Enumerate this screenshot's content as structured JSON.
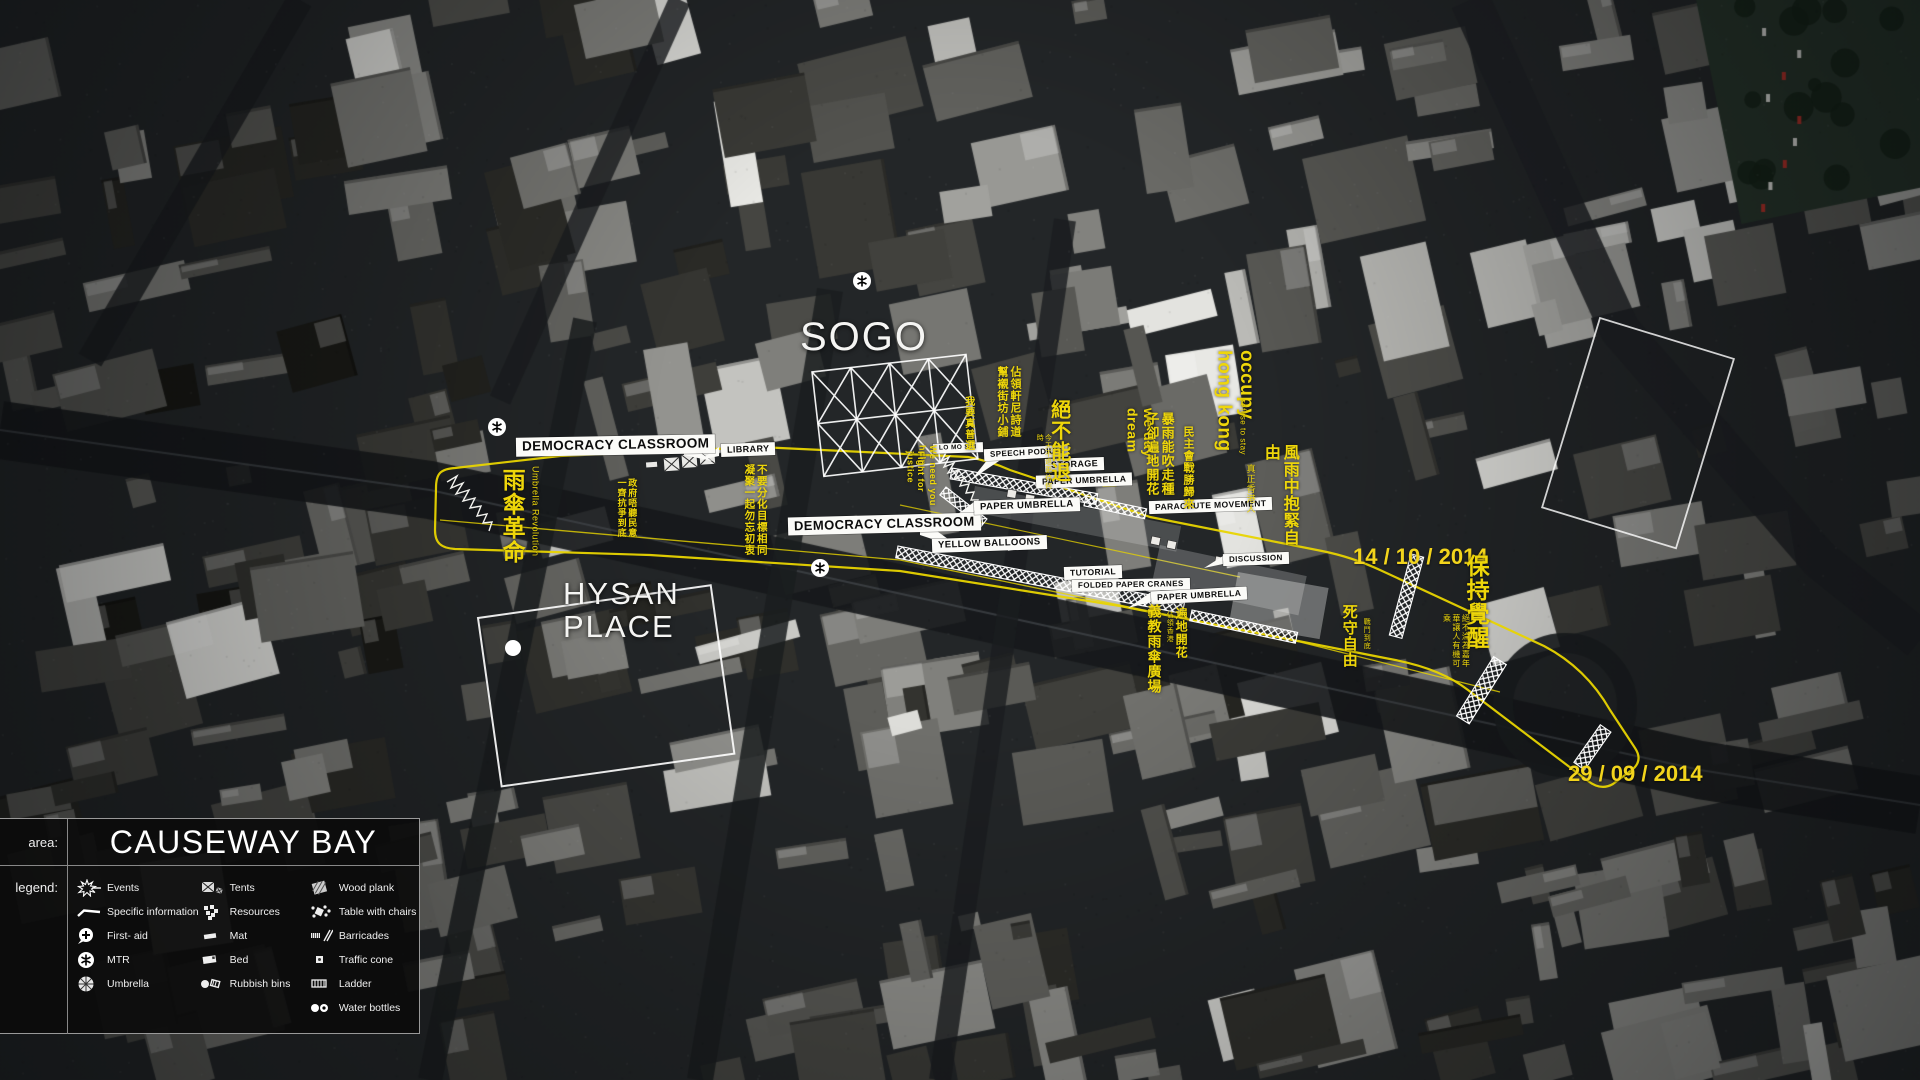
{
  "colors": {
    "annotation_yellow": "#eed60a",
    "date_yellow": "#f2d41c",
    "callout_bg": "#ffffff",
    "callout_text": "#0c0c0c",
    "panel_bg": "#0c0c0c"
  },
  "panel": {
    "area_label": "area:",
    "area_value": "CAUSEWAY BAY",
    "legend_label": "legend:",
    "columns": [
      {
        "items": [
          {
            "icon": "events-icon",
            "label": "Events"
          },
          {
            "icon": "specific-information-icon",
            "label": "Specific information"
          },
          {
            "icon": "first-aid-icon",
            "label": "First- aid"
          },
          {
            "icon": "mtr-icon",
            "label": "MTR"
          },
          {
            "icon": "umbrella-icon",
            "label": "Umbrella"
          }
        ]
      },
      {
        "items": [
          {
            "icon": "tents-icon",
            "label": "Tents"
          },
          {
            "icon": "resources-icon",
            "label": "Resources"
          },
          {
            "icon": "mat-icon",
            "label": "Mat"
          },
          {
            "icon": "bed-icon",
            "label": "Bed"
          },
          {
            "icon": "rubbish-bins-icon",
            "label": "Rubbish bins"
          }
        ]
      },
      {
        "items": [
          {
            "icon": "wood-plank-icon",
            "label": "Wood plank"
          },
          {
            "icon": "table-with-chairs-icon",
            "label": "Table with chairs"
          },
          {
            "icon": "barricades-icon",
            "label": "Barricades"
          },
          {
            "icon": "traffic-cone-icon",
            "label": "Traffic cone"
          },
          {
            "icon": "ladder-icon",
            "label": "Ladder"
          },
          {
            "icon": "water-bottles-icon",
            "label": "Water bottles"
          }
        ]
      }
    ]
  },
  "map": {
    "places": {
      "sogo": "SOGO",
      "hysan_line1": "HYSAN",
      "hysan_line2": "PLACE"
    },
    "dates": [
      {
        "text": "14 / 10 / 2014"
      },
      {
        "text": "29 / 09 / 2014"
      }
    ],
    "callouts": [
      {
        "label": "DEMOCRACY CLASSROOM"
      },
      {
        "label": "LIBRARY"
      },
      {
        "label": "DEMOCRACY CLASSROOM"
      },
      {
        "label": "LO MO SAI"
      },
      {
        "label": "SPEECH PODIUM"
      },
      {
        "label": "STORAGE"
      },
      {
        "label": "PAPER UMBRELLA"
      },
      {
        "label": "PAPER UMBRELLA"
      },
      {
        "label": "PARACHUTE MOVEMENT"
      },
      {
        "label": "YELLOW BALLOONS"
      },
      {
        "label": "TUTORIAL"
      },
      {
        "label": "FOLDED PAPER CRANES"
      },
      {
        "label": "PAPER UMBRELLA"
      },
      {
        "label": "DISCUSSION"
      }
    ],
    "slogans": [
      {
        "text": "雨傘革命",
        "sub": "Umbrella Revolution"
      },
      {
        "text": "政府唔聽民意一齊抗爭到底"
      },
      {
        "text": "不要分化目標相同凝聚一起勿忘初衷"
      },
      {
        "text": "我要真普選"
      },
      {
        "text": "佔領軒尼詩道幫襯街坊小鋪"
      },
      {
        "text": "絕不能退",
        "sub": "今天不退更待何時"
      },
      {
        "text": "We need you help"
      },
      {
        "text": "Fight for justice"
      },
      {
        "text": "we day dream"
      },
      {
        "text": "暴雨能吹走種子卻遍地開花"
      },
      {
        "text": "民主會戰勝歸來"
      },
      {
        "text": "occupy hong kong",
        "sub": "refuse to stay"
      },
      {
        "text": "風雨中抱緊自由",
        "sub": "真正香港人"
      },
      {
        "text": "保持覺醒",
        "sub": "絕不淪為嘉年華讓人有機可乘"
      },
      {
        "text": "死守自由",
        "sub": "戰鬥到底"
      },
      {
        "text": "義教雨傘廣場"
      },
      {
        "text": "遍地開花",
        "sub": "佔領香港"
      }
    ]
  }
}
